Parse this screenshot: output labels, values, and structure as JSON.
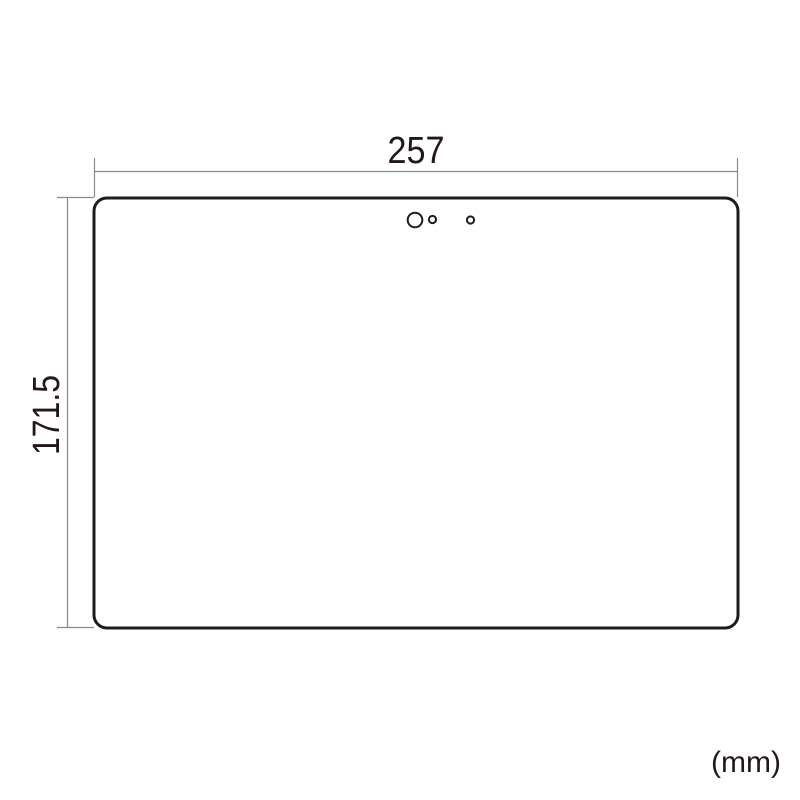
{
  "figure": {
    "unit_label": "(mm)",
    "subject": "rounded-rectangle device screen protector outline with camera and sensor holes"
  },
  "dimensions": {
    "width": {
      "label": "257",
      "value": 257,
      "unit": "mm"
    },
    "height": {
      "label": "171.5",
      "value": 171.5,
      "unit": "mm"
    }
  },
  "shapes": {
    "panel": "rounded-rectangle-outline",
    "camera_hole": "large-circle-cutout",
    "sensor_hole_1": "small-circle-cutout",
    "sensor_hole_2": "small-circle-cutout"
  },
  "colors": {
    "background": "#ffffff",
    "outline": "#1d1d1b",
    "dimension_line": "#898989",
    "text": "#231815"
  }
}
